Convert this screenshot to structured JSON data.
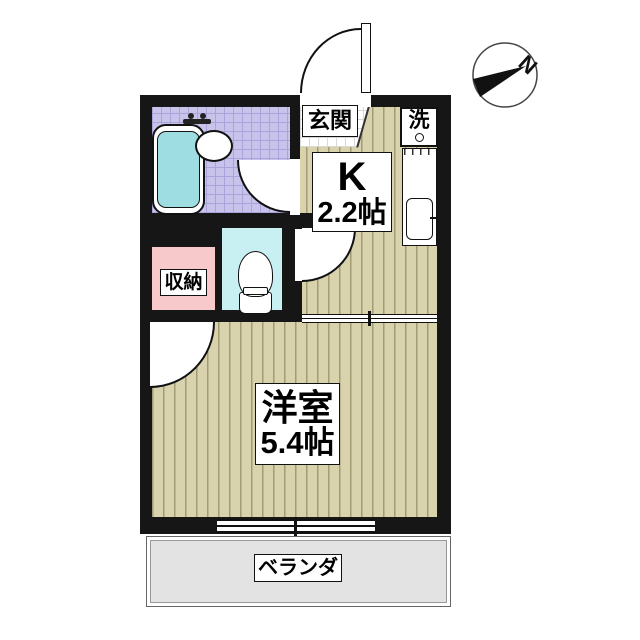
{
  "plan": {
    "entrance_label": "玄関",
    "laundry_label": "洗",
    "kitchen_label_1": "K",
    "kitchen_label_2": "2.2帖",
    "storage_label": "収納",
    "main_room_label_1": "洋室",
    "main_room_label_2": "5.4帖",
    "balcony_label": "ベランダ",
    "compass_label": "N"
  },
  "colors": {
    "wall": "#161616",
    "wood_floor": "#d8d2ad",
    "wood_stripe": "#a39b73",
    "bathroom_tile": "#c7c3ea",
    "bathroom_tile_grid": "#a9a4d9",
    "bathtub_water": "#9edde1",
    "toilet_floor": "#c8eff1",
    "storage_floor": "#f7c9ca",
    "balcony_floor": "#e3e3e3"
  }
}
